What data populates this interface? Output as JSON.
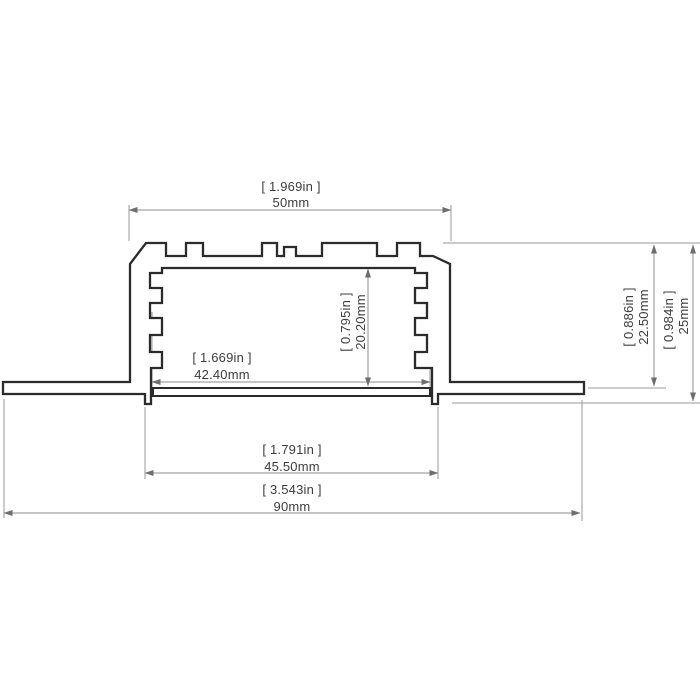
{
  "drawing": {
    "title": "Recessed LED aluminium profile cross-section",
    "colors": {
      "outline": "#2b2b2b",
      "dimension_line": "#8c8c8c",
      "arrow": "#6e6e6e",
      "text": "#3d3d3d",
      "background": "#ffffff"
    },
    "dimensions": {
      "body_width": {
        "inch": "[ 1.969in ]",
        "mm": "50mm"
      },
      "cavity_width": {
        "inch": "[ 1.669in ]",
        "mm": "42.40mm"
      },
      "cavity_height": {
        "inch": "[ 0.795in ]",
        "mm": "20.20mm"
      },
      "recess_height": {
        "inch": "[ 0.886in ]",
        "mm": "22.50mm"
      },
      "total_height": {
        "inch": "[ 0.984in ]",
        "mm": "25mm"
      },
      "cutout_width": {
        "inch": "[ 1.791in ]",
        "mm": "45.50mm"
      },
      "total_width": {
        "inch": "[ 3.543in ]",
        "mm": "90mm"
      }
    }
  }
}
